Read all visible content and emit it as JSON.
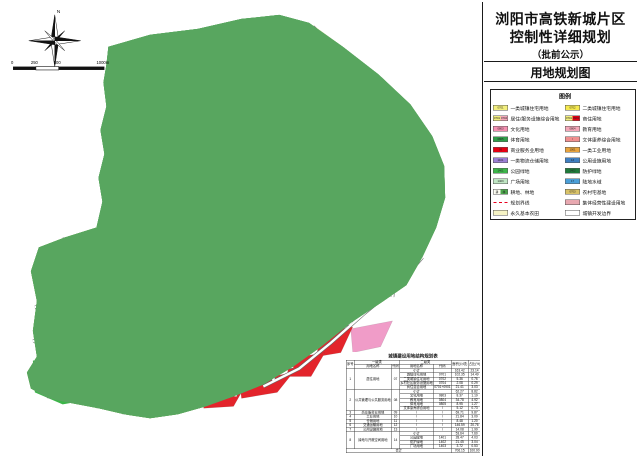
{
  "title_block": {
    "line1": "浏阳市高铁新城片区",
    "line2": "控制性详细规划",
    "line3": "（批前公示）",
    "map_name": "用地规划图"
  },
  "compass": {
    "north_label": "N"
  },
  "scale_bar": {
    "labels": [
      "0",
      "250",
      "500",
      "1000m"
    ]
  },
  "colors": {
    "boundary_red": "#e8001e",
    "residential_yellow": "#f3ea5a",
    "park_green": "#3cb549",
    "forest_green": "#58a65f",
    "commercial_red": "#e3242b",
    "education_pink": "#f09cc8",
    "industry_orange": "#f0a23a",
    "utility_blue": "#2b9cc8",
    "logistics_purple": "#8d66d4",
    "water_blue": "#54a0d8",
    "village_pink": "#e796a6",
    "farmland_cream": "#f1efc3"
  },
  "legend": {
    "heading": "图例",
    "items_left": [
      {
        "label": "一类城镇住宅用地",
        "type": "plain",
        "c1": "#f2ee7d",
        "code": "0701"
      },
      {
        "label": "居住/服务设施综合用地",
        "type": "split",
        "c1": "#f2ee7d",
        "c2": "#f4a7b9",
        "code1": "0701",
        "code2": "0704"
      },
      {
        "label": "文化用地",
        "type": "plain",
        "c1": "#f48fb1",
        "code": "0803"
      },
      {
        "label": "体育用地",
        "type": "plain",
        "c1": "#2f9e49",
        "code": "0805"
      },
      {
        "label": "商业服务业用地",
        "type": "plain",
        "c1": "#e60012",
        "code": "09"
      },
      {
        "label": "一类物流仓储用地",
        "type": "plain",
        "c1": "#9b7fd4",
        "code": "1101"
      },
      {
        "label": "公园绿地",
        "type": "plain",
        "c1": "#3cb549",
        "code": "1401"
      },
      {
        "label": "广场用地",
        "type": "plain",
        "c1": "#bfe6c3",
        "code": "1403"
      },
      {
        "label": "耕地、林地",
        "type": "double",
        "code1": "耕",
        "code2": "林",
        "c1": "#fdfdf2",
        "c2": "#4ca64c"
      },
      {
        "label": "规划界线",
        "type": "line"
      },
      {
        "label": "永久基本农田",
        "type": "hatch",
        "c1": "#f6f3c5"
      }
    ],
    "items_right": [
      {
        "label": "二类城镇住宅用地",
        "type": "plain",
        "c1": "#f5e94e",
        "code": "0702"
      },
      {
        "label": "商住用地",
        "type": "split",
        "c1": "#f2ee7d",
        "c2": "#e60012",
        "code1": "0701",
        "code2": "0901"
      },
      {
        "label": "教育用地",
        "type": "plain",
        "c1": "#f4a7b9",
        "code": "0804"
      },
      {
        "label": "文体康养综合用地",
        "type": "plain",
        "c1": "#f08f8f",
        "code": "/"
      },
      {
        "label": "一类工业用地",
        "type": "plain",
        "c1": "#e8a33d",
        "code": "1001"
      },
      {
        "label": "公用设施用地",
        "type": "plain",
        "c1": "#3f7fc1",
        "code": "13"
      },
      {
        "label": "防护绿地",
        "type": "plain",
        "c1": "#1f7a3a",
        "code": "1402"
      },
      {
        "label": "陆地水域",
        "type": "plain",
        "c1": "#4a9fd8",
        "code": "17"
      },
      {
        "label": "农村宅基地",
        "type": "plain",
        "c1": "#d8c268",
        "code": "0703"
      },
      {
        "label": "集体经营性建设用地",
        "type": "plain",
        "c1": "#e8a8b0",
        "code": ""
      },
      {
        "label": "城镇开发边界",
        "type": "hatch",
        "c1": "#ffffff"
      }
    ]
  },
  "table": {
    "title": "城镇建设用地结构规划表",
    "header_row1": [
      {
        "t": "序号",
        "rs": 2
      },
      {
        "t": "一级类",
        "cs": 2
      },
      {
        "t": "二级类",
        "cs": 2
      },
      {
        "t": "面积(公顷)",
        "rs": 2
      },
      {
        "t": "占比(%)",
        "rs": 2
      }
    ],
    "header_row2": [
      "用地名称",
      "代码",
      "用地名称",
      "代码"
    ],
    "rows": [
      [
        {
          "t": "1",
          "rs": 5
        },
        {
          "t": "居住用地",
          "rs": 5
        },
        {
          "t": "07",
          "rs": 5
        },
        "小计",
        "",
        "163.42",
        "23.14"
      ],
      [
        "城镇住宅用地",
        "0701",
        "102.35",
        "14.49"
      ],
      [
        "二类城镇住宅用地",
        "0702",
        "5.36",
        "0.76"
      ],
      [
        "乡村社区服务设施用地",
        "0704",
        "2.08",
        "0.29"
      ],
      [
        "商住混合用地",
        "0701+0901",
        "21.41",
        "3.03"
      ],
      [
        {
          "t": "2",
          "rs": 5
        },
        {
          "t": "公共管理与公共服务用地",
          "rs": 5
        },
        {
          "t": "08",
          "rs": 5
        },
        "小计",
        "",
        "62.27",
        "8.82"
      ],
      [
        "文化用地",
        "0803",
        "8.37",
        "1.19"
      ],
      [
        "教育用地",
        "0804",
        "34.78",
        "4.92"
      ],
      [
        "体育用地",
        "0805",
        "8.95",
        "1.27"
      ],
      [
        "文体康养综合用地",
        "/",
        "5.12",
        "0.73"
      ],
      [
        "3",
        "商业服务业用地",
        "09",
        "/",
        "/",
        "69.71",
        "9.87"
      ],
      [
        "4",
        "工业用地",
        "10",
        "/",
        "/",
        "21.84",
        "3.09"
      ],
      [
        "5",
        "仓储用地",
        "11",
        "/",
        "/",
        "8.48",
        "1.20"
      ],
      [
        "6",
        "交通运输用地",
        "12",
        "/",
        "/",
        "146.59",
        "20.76"
      ],
      [
        "7",
        "公用设施用地",
        "13",
        "/",
        "/",
        "14.08",
        "1.99"
      ],
      [
        {
          "t": "8",
          "rs": 4
        },
        {
          "t": "绿地与开敞空间用地",
          "rs": 4
        },
        {
          "t": "14",
          "rs": 4
        },
        "小计",
        "",
        "53.64",
        "7.60"
      ],
      [
        "公园绿地",
        "1401",
        "28.47",
        "4.03"
      ],
      [
        "防护绿地",
        "1402",
        "21.45",
        "3.04"
      ],
      [
        "广场用地",
        "1403",
        "3.72",
        "0.53"
      ],
      [
        {
          "t": "合计",
          "cs": 5
        },
        "706.15",
        "100.00"
      ]
    ]
  }
}
